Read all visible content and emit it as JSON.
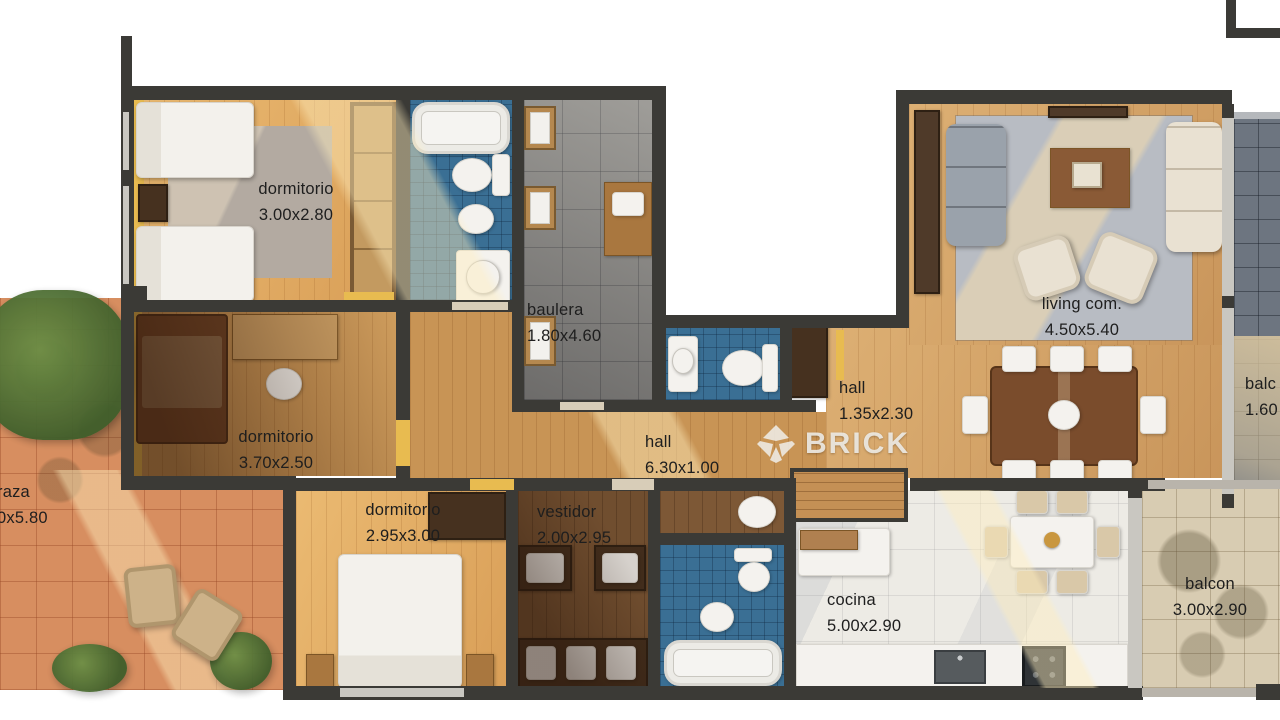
{
  "watermark": {
    "text": "BRICK"
  },
  "labels": {
    "dormitorio1": {
      "name": "dormitorio",
      "dims": "3.00x2.80"
    },
    "dormitorio2": {
      "name": "dormitorio",
      "dims": "3.70x2.50"
    },
    "dormitorio3": {
      "name": "dormitorio",
      "dims": "2.95x3.00"
    },
    "baulera": {
      "name": "baulera",
      "dims": "1.80x4.60"
    },
    "living": {
      "name": "living com.",
      "dims": "4.50x5.40"
    },
    "hall1": {
      "name": "hall",
      "dims": "1.35x2.30"
    },
    "hall2": {
      "name": "hall",
      "dims": "6.30x1.00"
    },
    "vestidor": {
      "name": "vestidor",
      "dims": "2.00x2.95"
    },
    "cocina": {
      "name": "cocina",
      "dims": "5.00x2.90"
    },
    "balcon1": {
      "name": "balcon",
      "dims": "3.00x2.90"
    },
    "terraza_partial": {
      "name": "raza",
      "dims": "0x5.80"
    },
    "balcon2_partial": {
      "name": "balc",
      "dims": "1.60"
    }
  },
  "colors": {
    "wall": "#3b3a36",
    "wood_floor": "#d7a160",
    "accent_gold": "#e8bb50",
    "bath_tile": "#3a6f94",
    "terrace_tile": "#d78e60",
    "slate_balcony": "#6d7580",
    "stone_balcony": "#d8ccb2",
    "kitchen_marble": "#edebe5",
    "label_text": "#1e1e1e",
    "watermark": "#ececec"
  }
}
